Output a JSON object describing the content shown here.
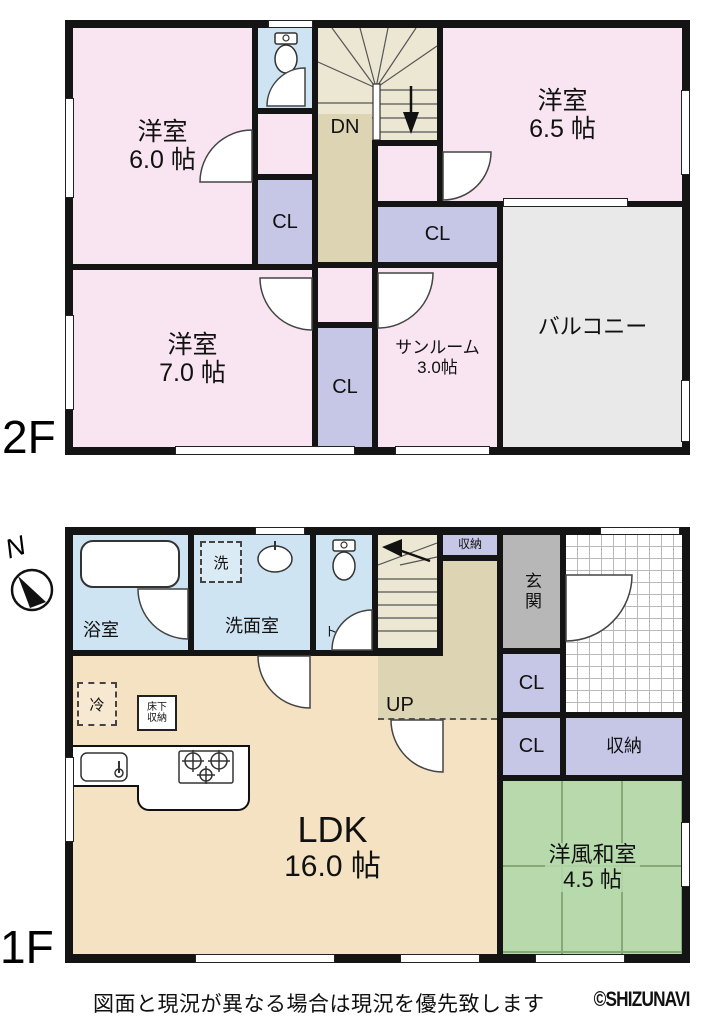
{
  "colors": {
    "wall": "#141414",
    "western_room_pink": "#f8e5f1",
    "closet_purple": "#c6c6e6",
    "wet_area_blue": "#cfe4f2",
    "stairs_cream": "#ebe7d3",
    "hall_beige": "#ddd4b4",
    "ldk_tan": "#f4e2c2",
    "balcony_gray": "#e9e9e9",
    "entrance_gray": "#b7b7b7",
    "tatami_green": "#b7d9ab"
  },
  "compass": {
    "north": "N"
  },
  "floor2": {
    "label": "2F",
    "yo60": {
      "name": "洋室",
      "size": "6.0 帖"
    },
    "toilet": {
      "label": "トイレ"
    },
    "stairs": {
      "dn": "DN"
    },
    "yo65": {
      "name": "洋室",
      "size": "6.5 帖"
    },
    "cl1": {
      "label": "CL"
    },
    "cl2": {
      "label": "CL"
    },
    "cl3": {
      "label": "CL"
    },
    "sunroom": {
      "name": "サンルーム",
      "size": "3.0帖"
    },
    "balcony": {
      "label": "バルコニー"
    },
    "yo70": {
      "name": "洋室",
      "size": "7.0 帖"
    }
  },
  "floor1": {
    "label": "1F",
    "bath": {
      "label": "浴室"
    },
    "washer": {
      "label": "洗"
    },
    "washroom": {
      "label": "洗面室"
    },
    "toilet": {
      "label": "トイレ"
    },
    "stairs": {
      "up": "UP"
    },
    "storage_top": {
      "label": "収納"
    },
    "genkan": {
      "label": "玄関"
    },
    "cl4": {
      "label": "CL"
    },
    "cl5": {
      "label": "CL"
    },
    "storage2": {
      "label": "収納"
    },
    "washitsu": {
      "name": "洋風和室",
      "size": "4.5 帖"
    },
    "ldk": {
      "name": "LDK",
      "size": "16.0 帖"
    },
    "fridge": {
      "label": "冷"
    },
    "floor_storage": {
      "line1": "床下",
      "line2": "収納"
    }
  },
  "footer": {
    "disclaimer": "図面と現況が異なる場合は現況を優先致します",
    "logo": "©SHIZUNAVI"
  }
}
